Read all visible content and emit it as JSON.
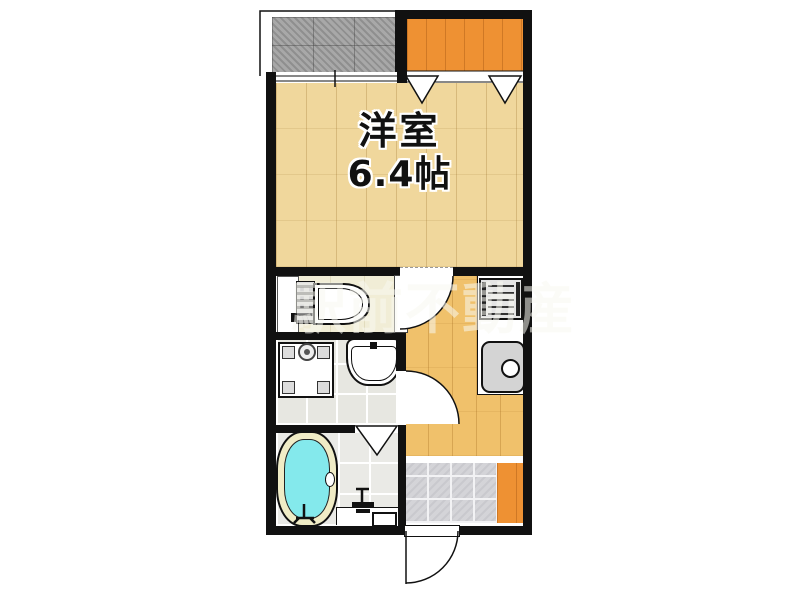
{
  "main_room": {
    "name": "洋室",
    "size": "6.4帖"
  },
  "watermark": {
    "text": "駅前不動産"
  },
  "colors": {
    "wall": "#111111",
    "floor_main": "#f0d79c",
    "floor_kitchen": "#f0c16b",
    "balcony_orange": "#ee9133",
    "balcony_gray": "#a8a8a8",
    "toilet_floor": "#f1edd6",
    "washroom_floor": "#e7e7e1",
    "bathroom_floor": "#eaeae6",
    "genkan_tile": "#d4d4d8",
    "tub_water": "#84e9ec",
    "tub_rim": "#f0ecc6",
    "watermark_color": "rgba(248,248,240,0.55)"
  }
}
